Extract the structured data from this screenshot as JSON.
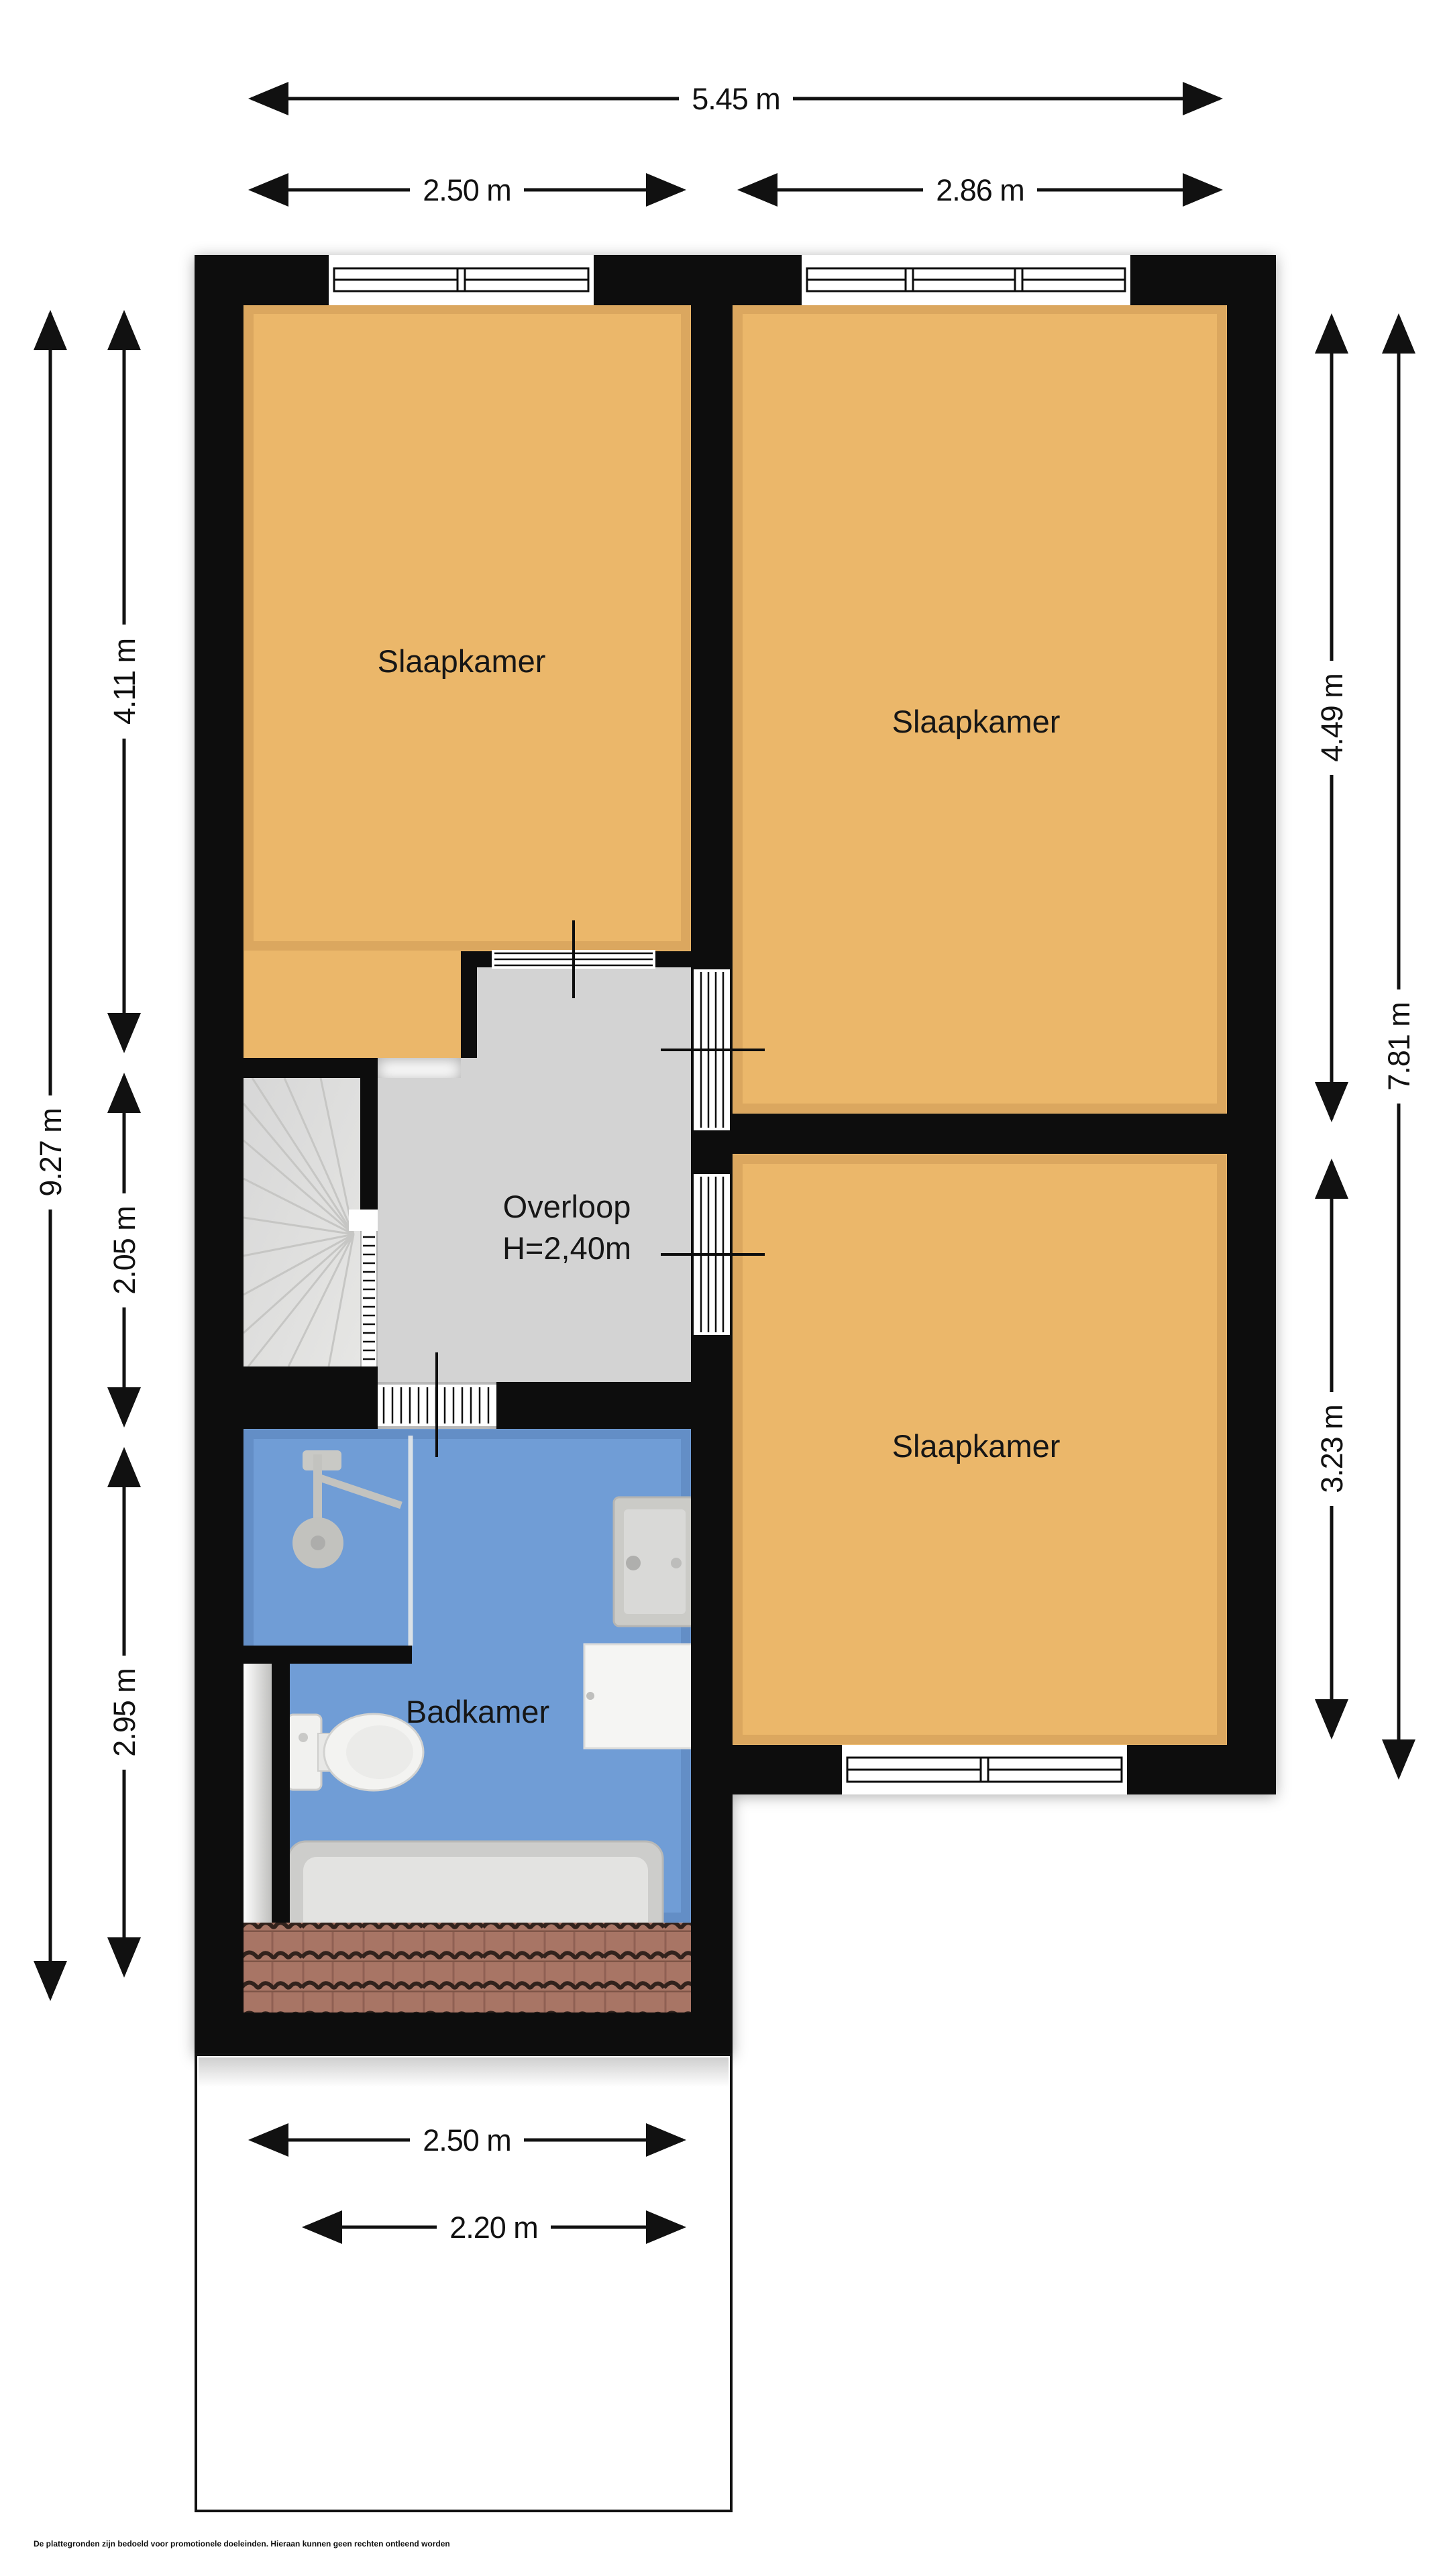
{
  "document": {
    "type": "floorplan",
    "floor_note": "upper floor plan with three bedrooms, landing, bathroom and roof section",
    "disclaimer": "De plattegronden zijn bedoeld voor promotionele doeleinden. Hieraan kunnen geen rechten ontleend worden"
  },
  "rooms": {
    "bedroom_tl": {
      "label": "Slaapkamer"
    },
    "bedroom_tr": {
      "label": "Slaapkamer"
    },
    "bedroom_br": {
      "label": "Slaapkamer"
    },
    "landing": {
      "label": "Overloop",
      "height": "H=2,40m"
    },
    "bathroom": {
      "label": "Badkamer"
    }
  },
  "dimensions": {
    "top_total": "5.45 m",
    "top_left": "2.50 m",
    "top_right": "2.86 m",
    "left_total": "9.27 m",
    "left_top": "4.11 m",
    "left_middle": "2.05 m",
    "left_bottom": "2.95 m",
    "right_top": "4.49 m",
    "right_total": "7.81 m",
    "right_bottom": "3.23 m",
    "bottom_outer": "2.50 m",
    "bottom_inner": "2.20 m"
  },
  "fixtures": [
    "stairs-icon",
    "shower-icon",
    "toilet-icon",
    "sink-icon",
    "cabinet-icon",
    "bathtub-icon",
    "roof-tiles",
    "window-icon",
    "door-icon",
    "railing-icon"
  ],
  "colors": {
    "wall": "#0b0b0b",
    "room_floor": "#ebb76a",
    "room_floor_edge": "#8a5a1e",
    "landing_floor": "#d3d3d3",
    "stairs_floor": "#dedede",
    "bathroom_floor": "#6f9dd6",
    "bathroom_floor_edge": "#1f3e6e",
    "roof_tiles": "#a87565",
    "fixture_gray": "#c9c9c5",
    "fixture_white": "#f2f2f0"
  }
}
